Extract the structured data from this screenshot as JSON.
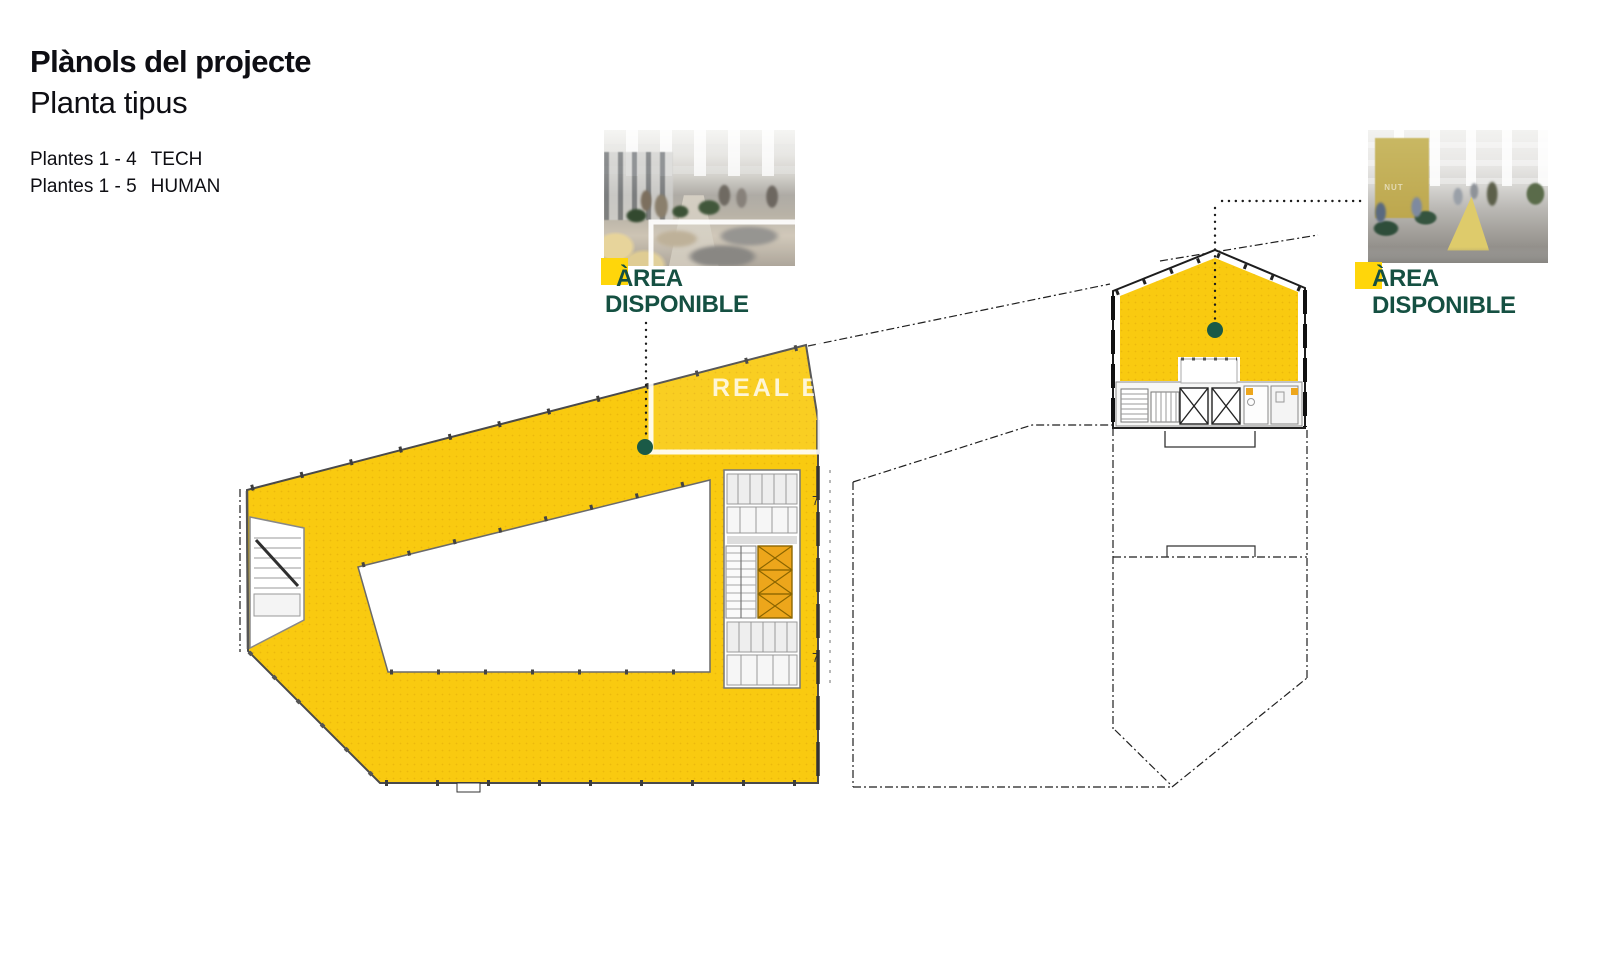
{
  "header": {
    "title": "Plànols del projecte",
    "subtitle": "Planta tipus"
  },
  "floors": [
    {
      "range": "Plantes 1 - 4",
      "program": "TECH"
    },
    {
      "range": "Plantes 1 - 5",
      "program": "HUMAN"
    }
  ],
  "area_labels": [
    {
      "line1": "ÀREA",
      "line2": "DISPONIBLE"
    },
    {
      "line1": "ÀREA",
      "line2": "DISPONIBLE"
    }
  ],
  "watermark": "REAL ESTAT",
  "section_marks": [
    "7",
    "7"
  ],
  "photos": {
    "right": {
      "wall_text": "NUT"
    }
  },
  "colors": {
    "plan_yellow": "#F9CA10",
    "highlight_yellow": "#FFD60A",
    "elevator_amber": "#EDA61B",
    "label_green": "#155042",
    "dot_green": "#1A5A47",
    "wall_gray": "#4A4A4A",
    "line_black": "#1C1C1C"
  }
}
